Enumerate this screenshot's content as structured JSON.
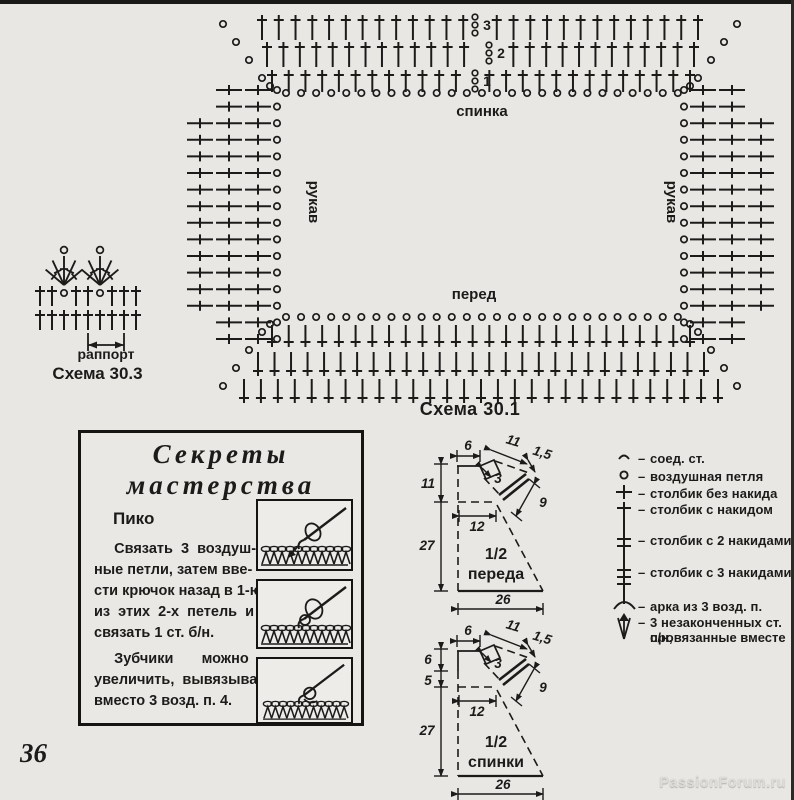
{
  "page": {
    "number": "36",
    "watermark": "PassionForum.ru",
    "bg": "#e9e7e3",
    "ink": "#1c1b1a"
  },
  "chart_main": {
    "caption": "Схема 30.1",
    "labels": {
      "top": "спинка",
      "bottom": "перед",
      "left_side": "рукав",
      "right_side": "рукав"
    },
    "row_numbers": [
      "1",
      "2",
      "3"
    ],
    "structure": {
      "top_rows": 3,
      "bottom_rows": 3,
      "side_rows": 16,
      "top_stitches": [
        26,
        27,
        27
      ],
      "bottom_stitches": [
        26,
        28,
        29
      ],
      "side_stitches_per_row": 3,
      "chain_circles_top": 27,
      "chain_circles_bottom": 27
    }
  },
  "chart_small": {
    "caption": "Схема 30.3",
    "repeat_label": "раппорт",
    "structure": {
      "fan_count": 2,
      "fan_spokes": 5,
      "mid_row_stitches": 9,
      "mid_row_chain_positions": [
        2,
        5
      ],
      "bottom_row_stitches": 9
    }
  },
  "tips_box": {
    "title_line1": "Секреты",
    "title_line2": "мастерства",
    "subtitle": "Пико",
    "p1_lines": [
      "     Связать  3  воздуш-",
      "ные петли, затем вве-",
      "сти крючок назад в 1-ю",
      "из  этих  2-х  петель  и",
      "связать 1 ст. б/н."
    ],
    "p2_lines": [
      "     Зубчики       можно",
      "увеличить,  вывязывая",
      "вместо 3 возд. п. 4."
    ]
  },
  "schematics": {
    "front": {
      "label_top": "1/2",
      "label_bottom": "переда",
      "m": {
        "top_width": "6",
        "shoulder": "11",
        "shoulder_drop": "1,5",
        "neck": "3",
        "armhole": "9",
        "side_upper": "11",
        "side_lower": "27",
        "half_chest": "12",
        "bottom_width": "26"
      }
    },
    "back": {
      "label_top": "1/2",
      "label_bottom": "спинки",
      "m": {
        "top_width": "6",
        "shoulder": "11",
        "shoulder_drop": "1,5",
        "neck": "3",
        "armhole": "9",
        "side_upper": "6",
        "side_mid": "5",
        "side_lower": "27",
        "half_chest": "12",
        "bottom_width": "26"
      }
    }
  },
  "legend": {
    "separator": "–",
    "items": [
      {
        "icon": "slip-stitch-icon",
        "label": "соед. ст."
      },
      {
        "icon": "chain-stitch-icon",
        "label": "воздушная петля"
      },
      {
        "icon": "single-crochet-icon",
        "label": "столбик без накида"
      },
      {
        "icon": "double-crochet-icon",
        "label": "столбик с накидом"
      },
      {
        "icon": "treble-2-icon",
        "label": "столбик с 2 накидами"
      },
      {
        "icon": "treble-3-icon",
        "label": "столбик с 3 накидами"
      },
      {
        "icon": "arch-icon",
        "label": "арка из 3 возд. п."
      },
      {
        "icon": "cluster-icon",
        "label": "3 незаконченных ст. с/н,",
        "label2": "провязанные вместе"
      }
    ]
  }
}
